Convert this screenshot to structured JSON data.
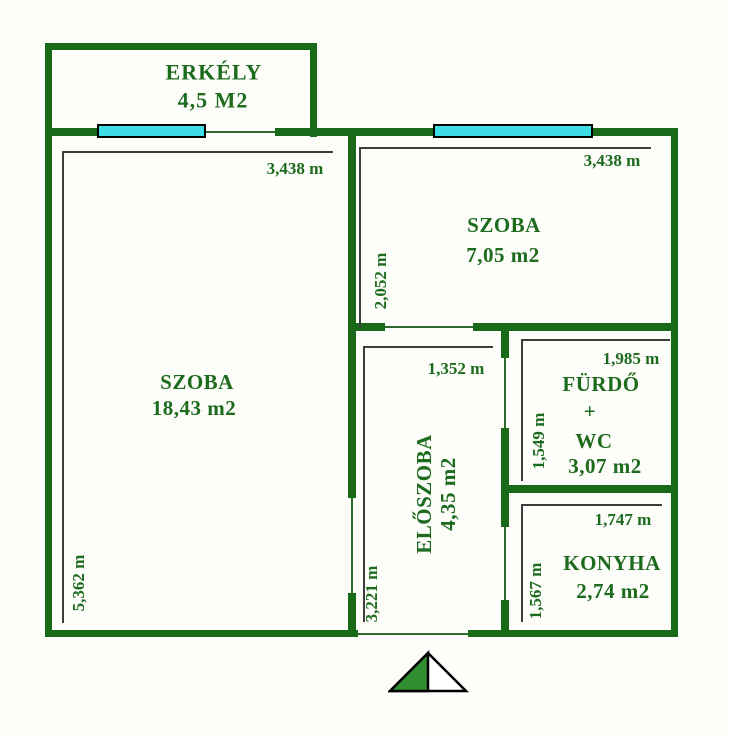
{
  "title": "Apartment floor plan",
  "colors": {
    "wall": "#186a18",
    "text": "#1d6b1d",
    "window": "#3edde6",
    "dimension_line": "#3d3d3d",
    "north_arrow_fill": "#2f8f2f"
  },
  "rooms": {
    "erkely": {
      "name": "ERKÉLY",
      "area": "4,5 M2"
    },
    "szoba_large": {
      "name": "SZOBA",
      "area": "18,43 m2",
      "dim_top": "3,438 m",
      "dim_left": "5,362 m"
    },
    "szoba_small": {
      "name": "SZOBA",
      "area": "7,05 m2",
      "dim_top": "3,438 m",
      "dim_left": "2,052 m"
    },
    "eloszoba": {
      "name": "ELŐSZOBA",
      "area": "4,35 m2",
      "dim_top": "1,352 m",
      "dim_left": "3,221 m"
    },
    "furdo": {
      "name_line1": "FÜRDŐ",
      "name_line2": "+",
      "name_line3": "WC",
      "area": "3,07 m2",
      "dim_top": "1,985 m",
      "dim_left": "1,549 m"
    },
    "konyha": {
      "name": "KONYHA",
      "area": "2,74 m2",
      "dim_top": "1,747 m",
      "dim_left": "1,567 m"
    }
  }
}
